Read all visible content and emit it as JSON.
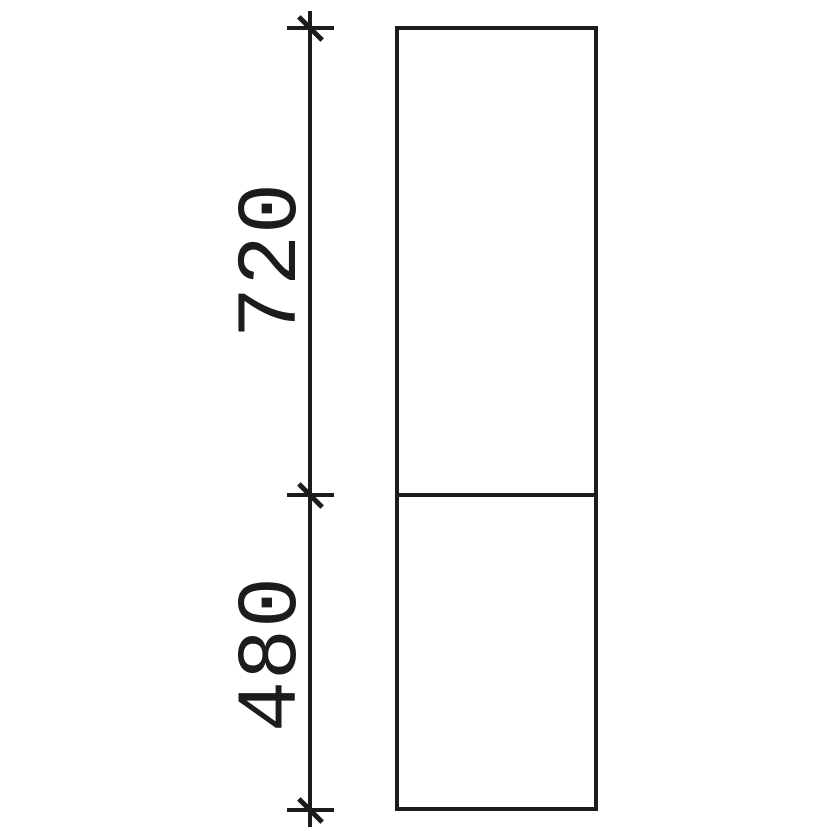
{
  "drawing": {
    "background_color": "#ffffff",
    "line_color": "#1c1c1c",
    "dimensions": {
      "upper": {
        "value": "720"
      },
      "lower": {
        "value": "480"
      }
    },
    "sections_count": 2
  }
}
